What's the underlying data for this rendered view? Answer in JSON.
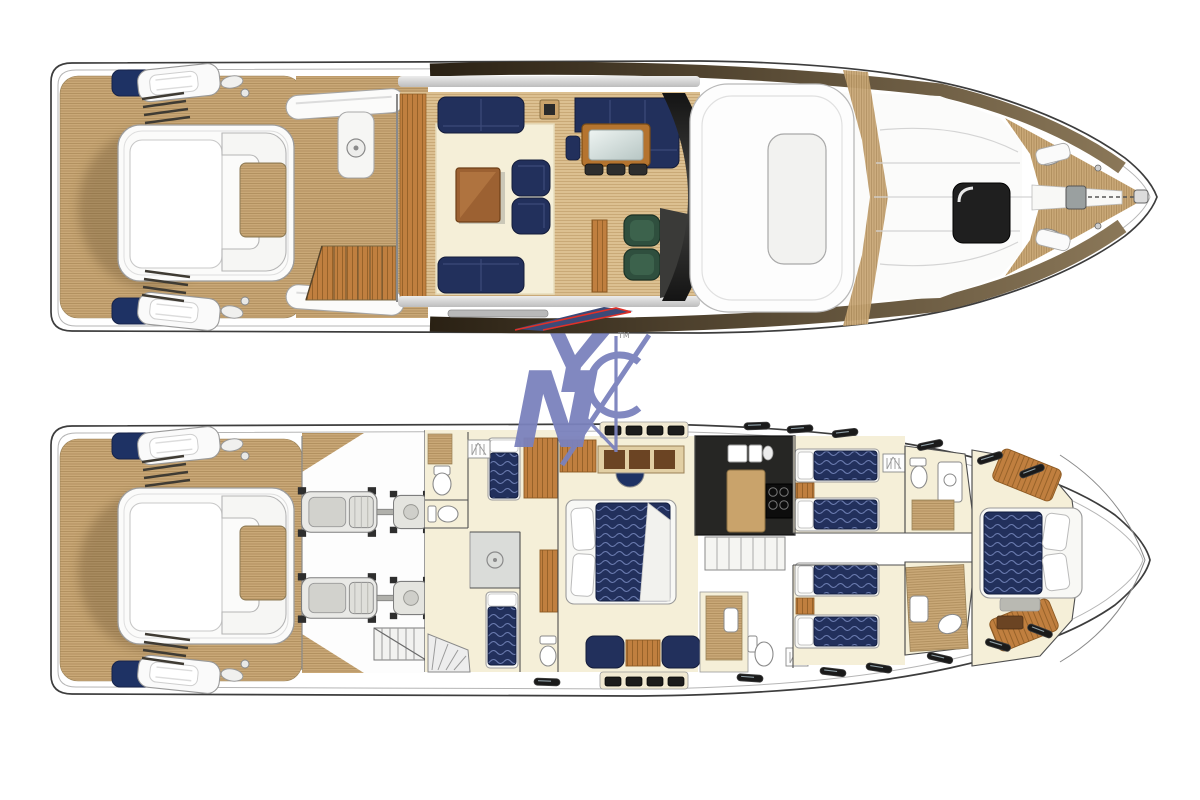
{
  "watermark": {
    "letters": [
      "N",
      "Y",
      "C"
    ],
    "trademark": "TM"
  },
  "palette": {
    "page_bg": "#ffffff",
    "hull_outline": "#3d3d3d",
    "hull_inner_line": "#b2b2b2",
    "teak": "#c9a877",
    "teak_line": "#ab8a58",
    "teak_light": "#dcc091",
    "teak_light_line": "#c3a26e",
    "navy": "#22305c",
    "navy_wave": "#6b7cb0",
    "navy_accent": "#1e3264",
    "cream": "#f5efd8",
    "wood": "#c07f3f",
    "wood_dark": "#8d5a23",
    "wood_table": "#9c6132",
    "green": "#2f4f3e",
    "dark": "#1d1d1b",
    "galley_dark": "#262624",
    "red": "#e03128",
    "silver": "#cfcfcf",
    "band_dark": "#2a2114",
    "band_light": "#8a7758",
    "logo": "#7b82bd",
    "swoosh_navy": "#3c4a78",
    "white_deck": "#fbfbfa"
  }
}
